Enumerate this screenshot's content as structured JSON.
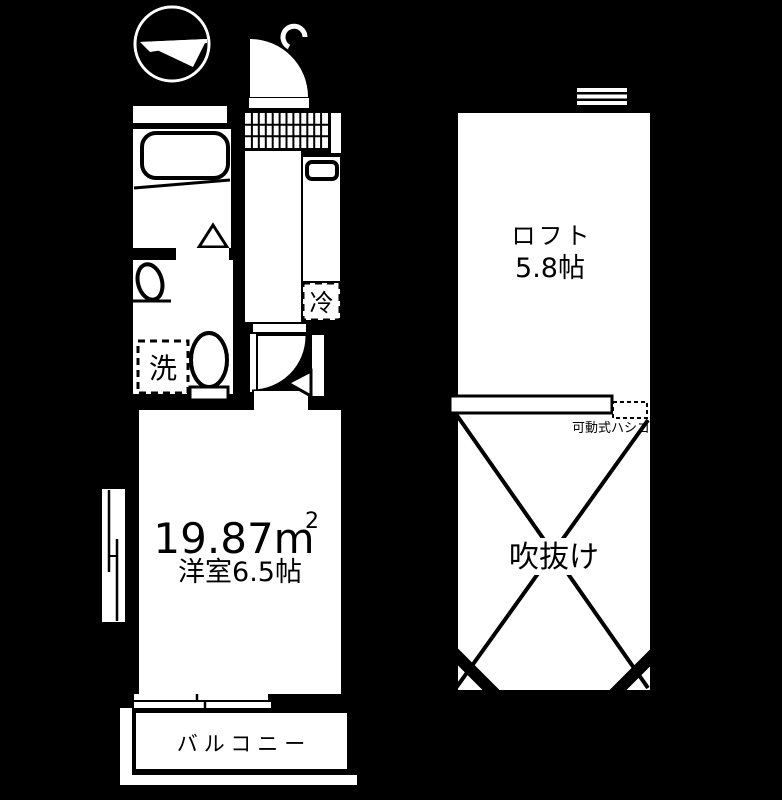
{
  "colors": {
    "background": "#000000",
    "floor": "#ffffff",
    "line": "#000000"
  },
  "floor_plan": {
    "first_floor": {
      "washroom": {
        "washer_label": "洗"
      },
      "kitchen": {
        "fridge_label": "冷"
      },
      "main_room": {
        "area_value": "19.87m",
        "area_superscript": "2",
        "size_label": "洋室6.5帖"
      },
      "balcony": {
        "label": "バルコニー"
      }
    },
    "loft_floor": {
      "loft": {
        "label": "ロフト",
        "size_label": "5.8帖"
      },
      "void": {
        "label": "吹抜け"
      },
      "ladder": {
        "label": "可動式ハシゴ"
      }
    }
  }
}
